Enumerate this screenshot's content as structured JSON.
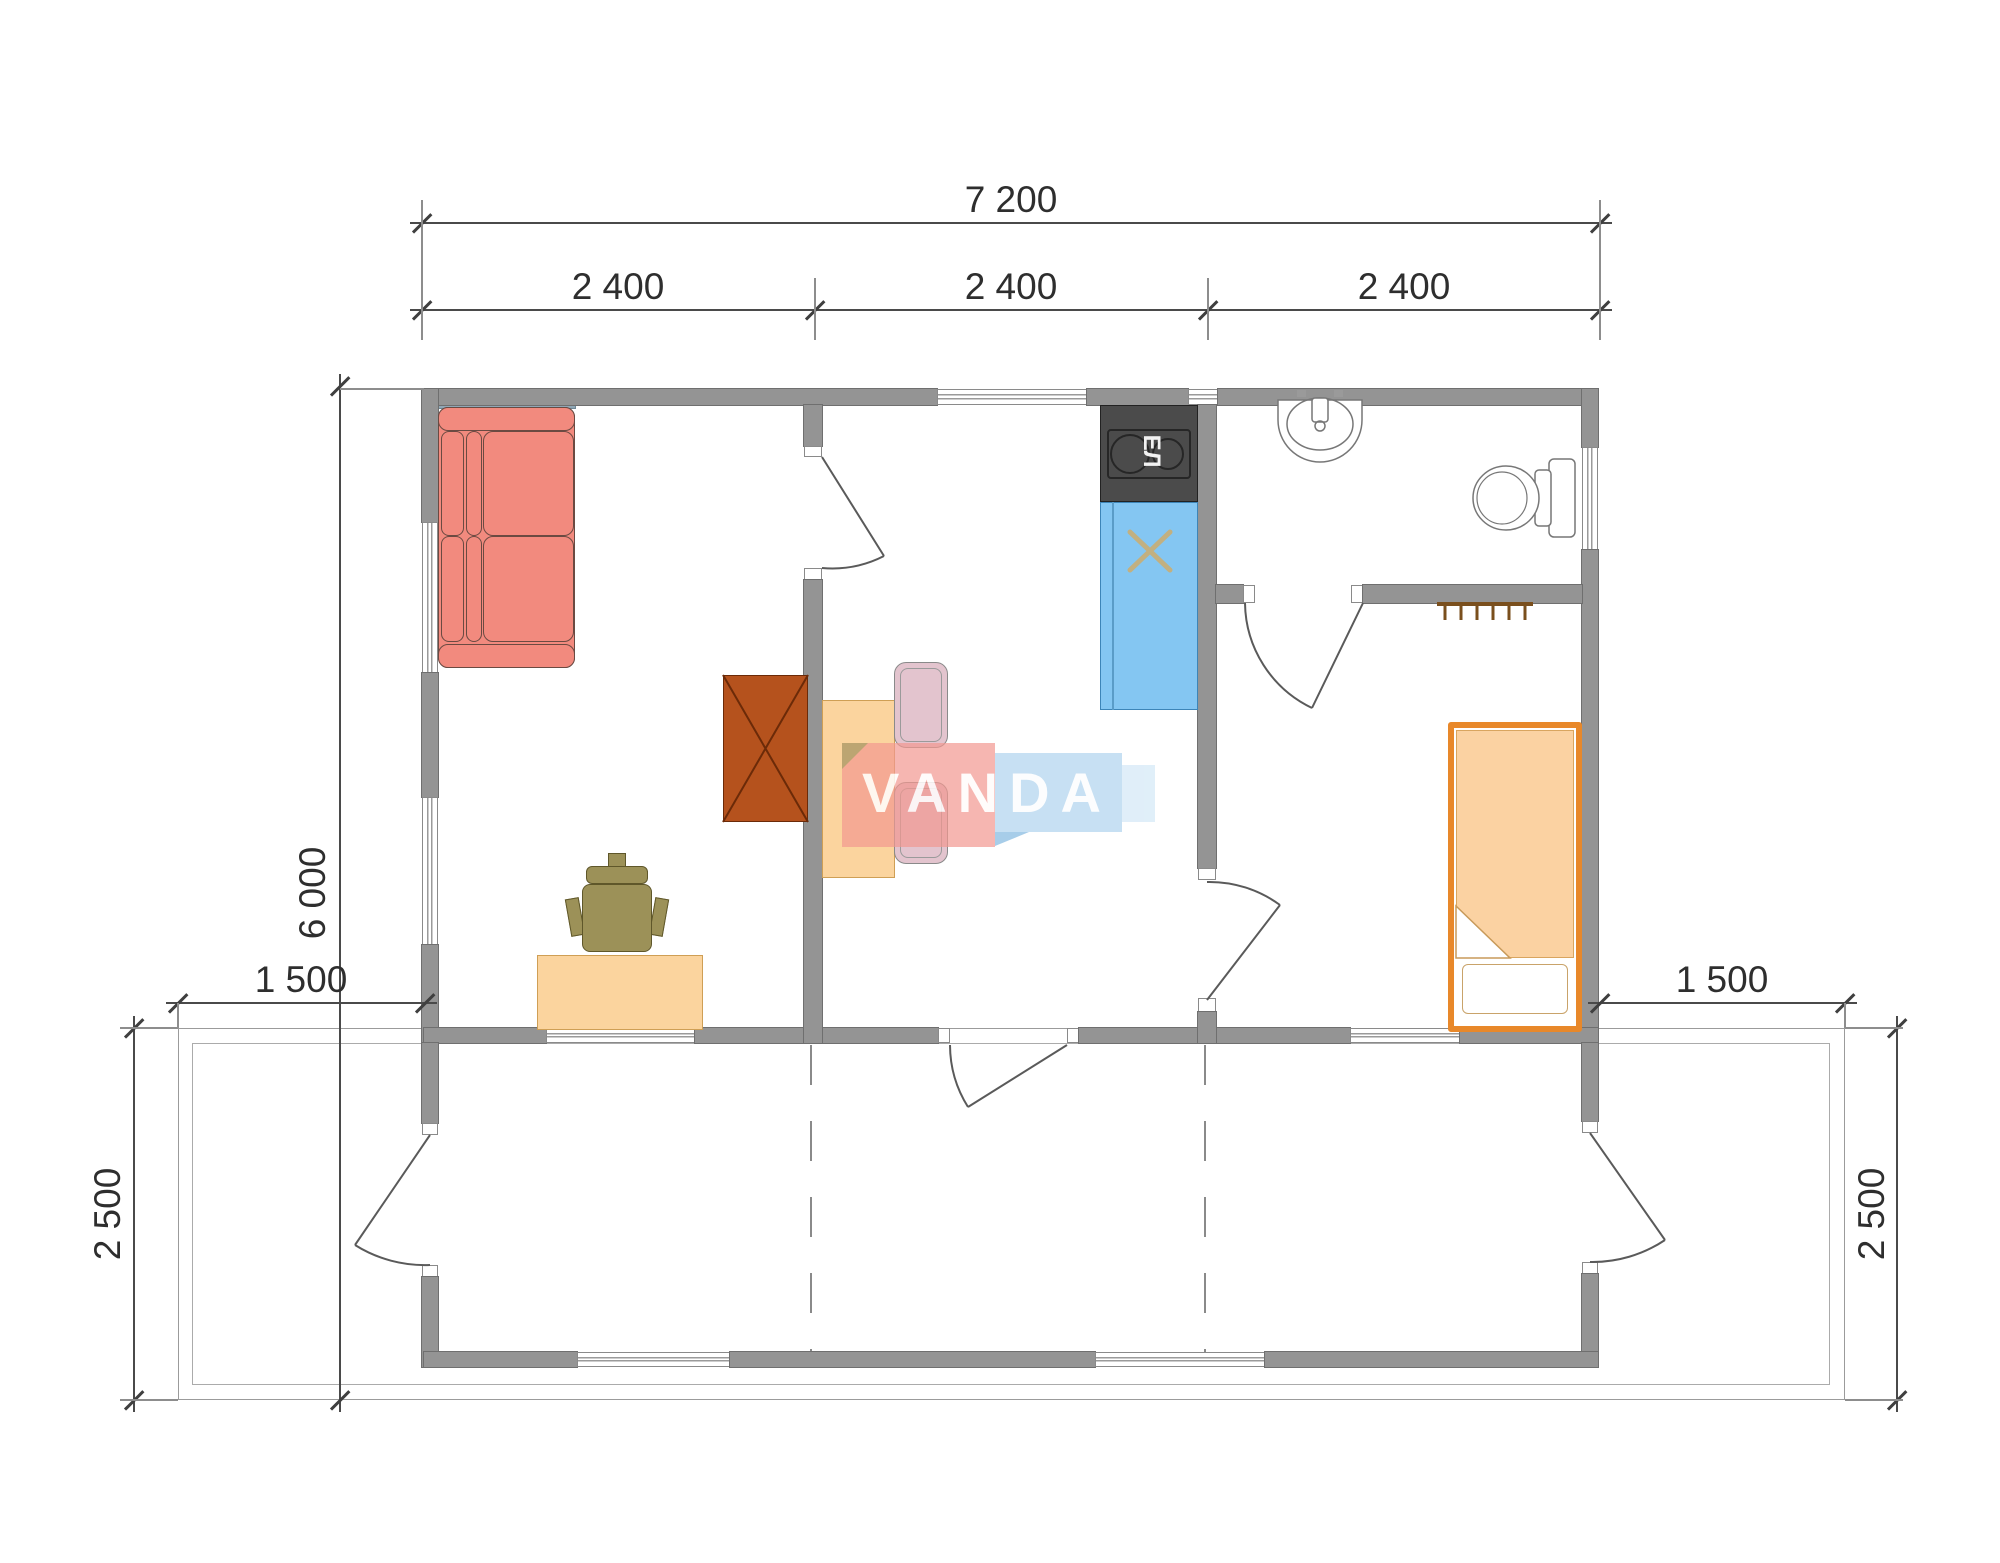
{
  "drawing": {
    "type": "house floor plan",
    "watermark": {
      "text": "VANDA"
    },
    "stove_label": "ЕЛ"
  },
  "dimensions": {
    "top_total": "7 200",
    "top_segments": [
      "2 400",
      "2 400",
      "2 400"
    ],
    "left_height": "6 000",
    "terrace_left_width": "1 500",
    "terrace_right_width": "1 500",
    "terrace_left_depth": "2 500",
    "terrace_right_depth": "2 500"
  },
  "furniture_symbols": [
    "corner-sofa",
    "wardrobe",
    "dining-table",
    "dining-chairs",
    "desk",
    "office-chair",
    "electric-stove",
    "kitchen-sink",
    "washbasin",
    "toilet",
    "radiator",
    "single-bed"
  ],
  "colors": {
    "wall": "#949494",
    "sofa": "#f28a7e",
    "wardrobe": "#b5521d",
    "wood": "#fbd49e",
    "sink_blue": "#84c6f2",
    "stove_dark": "#4b4b4b",
    "bed_orange": "#e8882a",
    "blanket": "#fbd2a2",
    "logo_pink": "#f29891",
    "logo_blue": "#b4d6ee",
    "dimension_text": "#2e2e2e"
  }
}
